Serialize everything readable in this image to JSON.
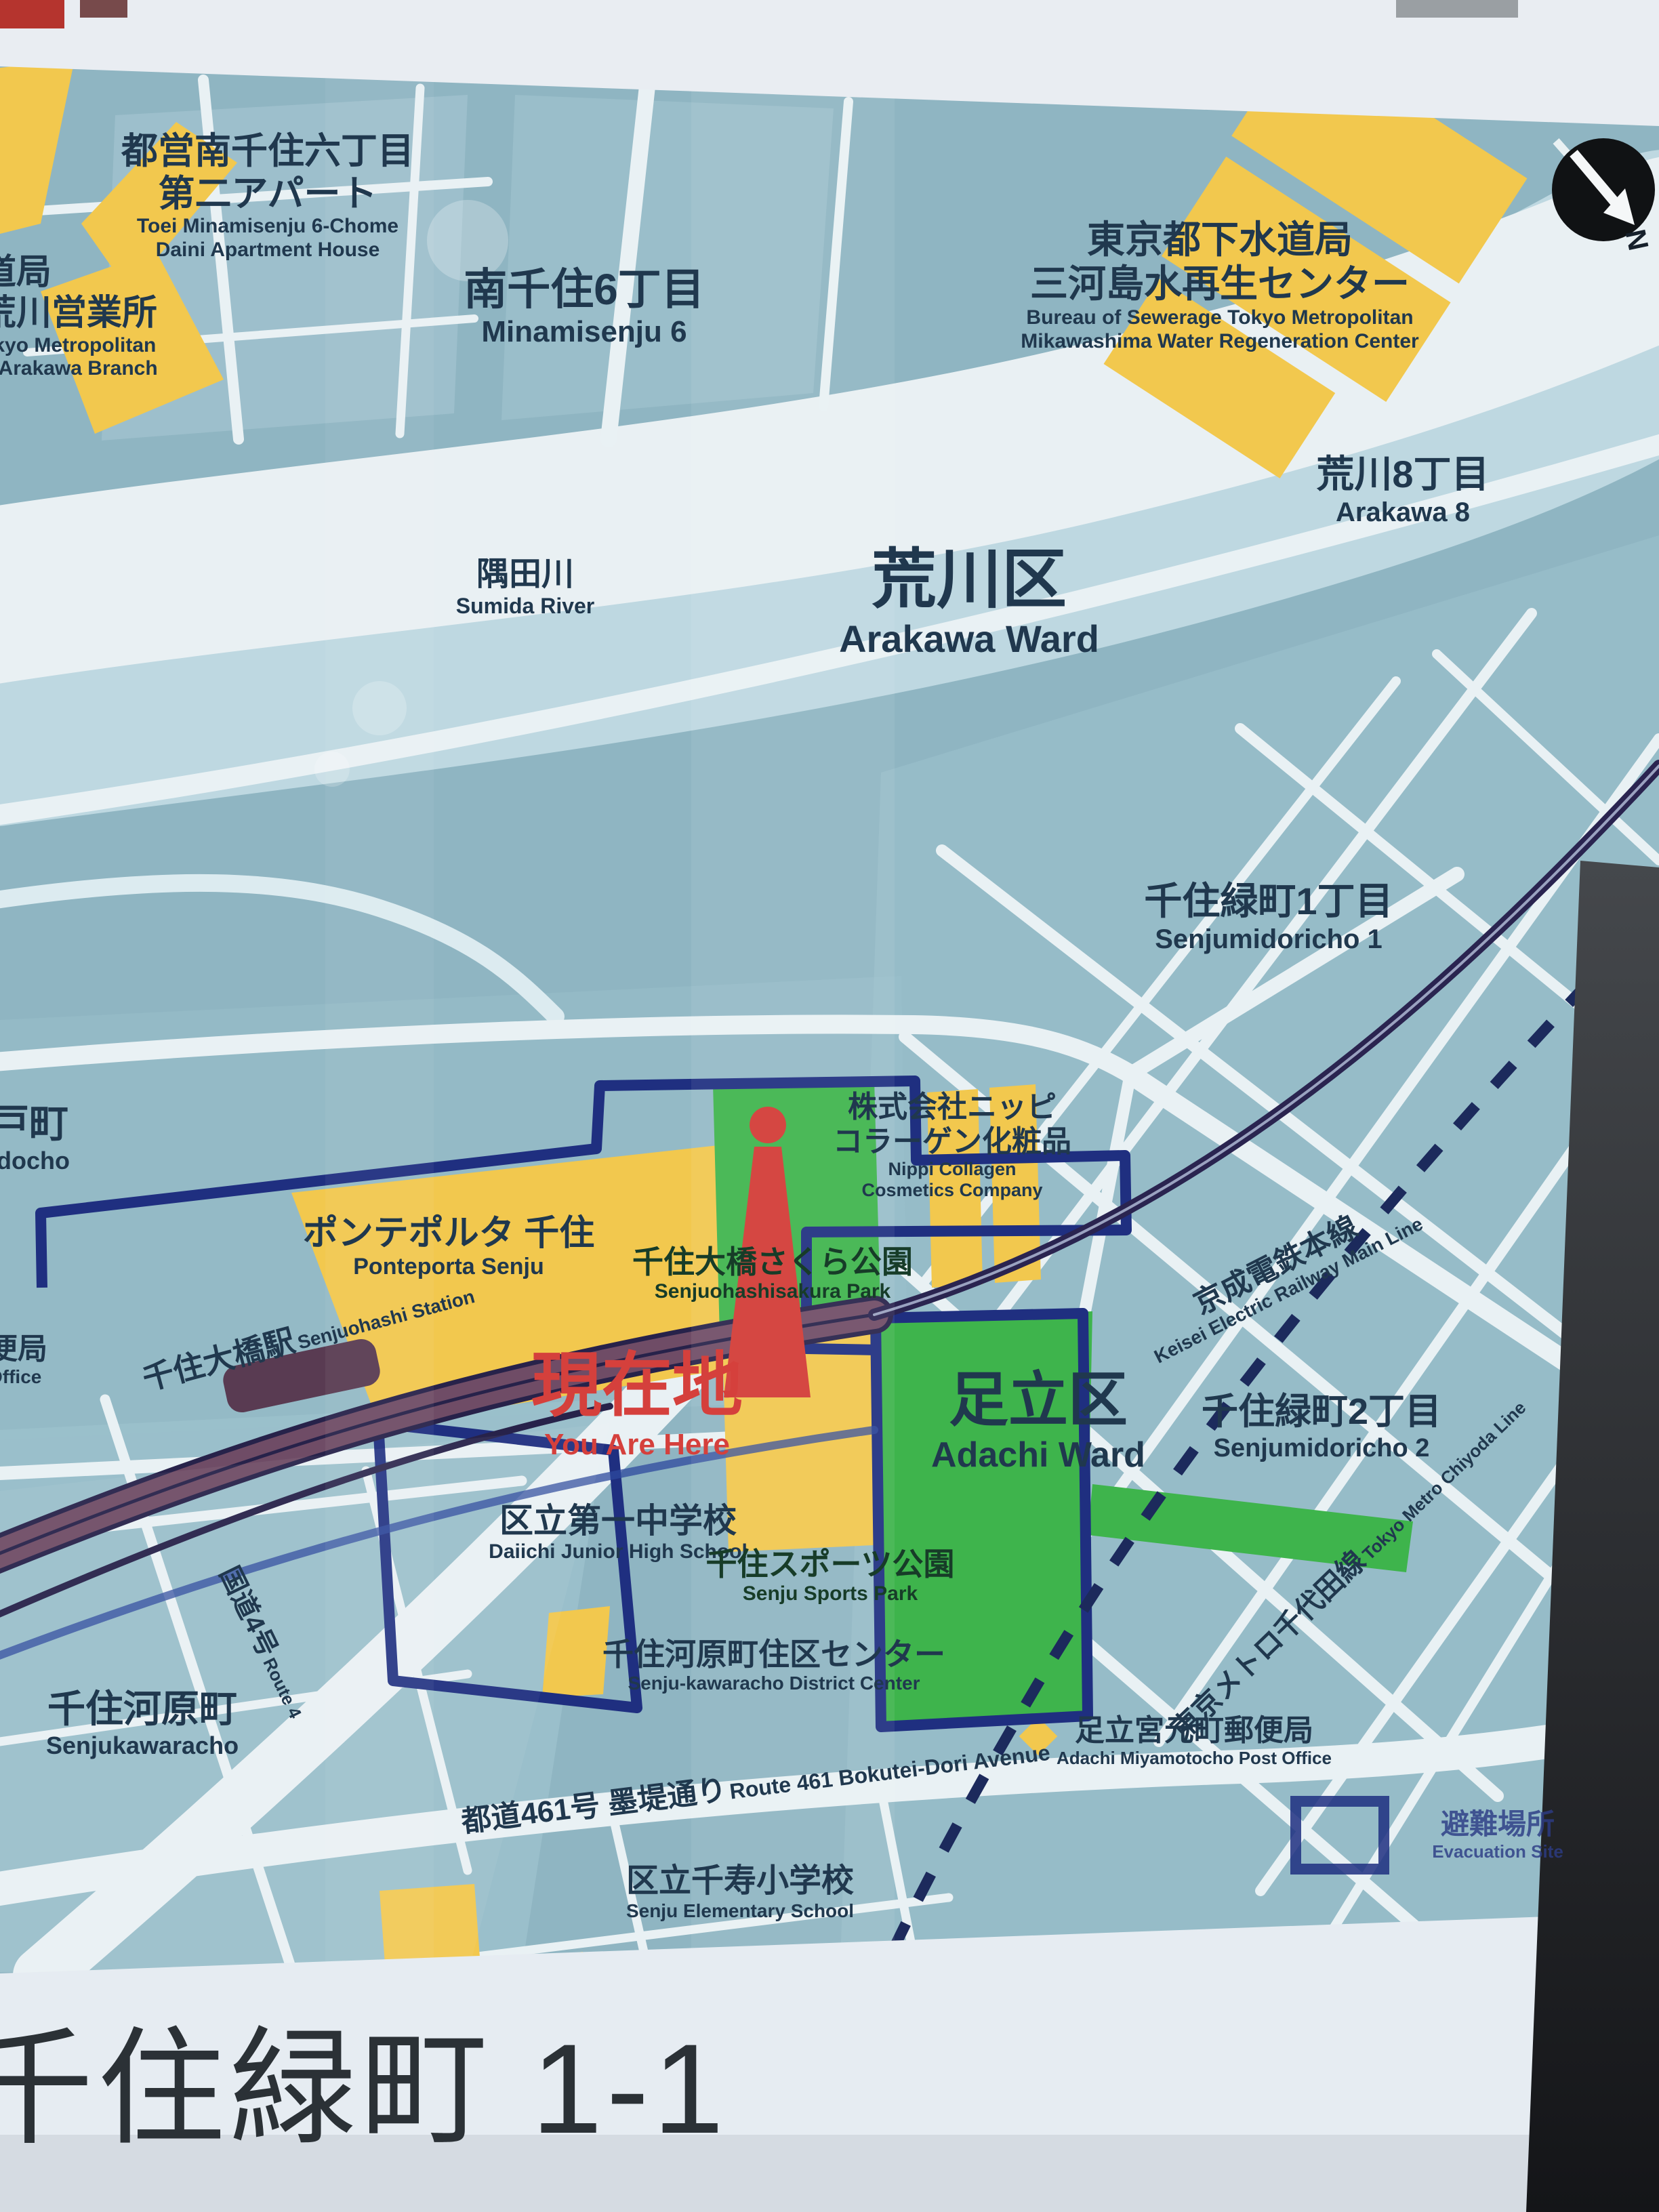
{
  "sign": {
    "title": "千住緑町 1-1",
    "compass": {
      "n": "N"
    },
    "legend": {
      "jp": "避難場所",
      "en": "Evacuation Site"
    },
    "colors": {
      "map_yellow": "#f2c84e",
      "map_green": "#3eb44c",
      "marker_red": "#d23a34",
      "boundary_navy": "#1f2f80",
      "railway_purple": "#6f4c66",
      "text_navy": "#20384e",
      "river_white": "#e9f0f3"
    },
    "labels": {
      "toei": {
        "jp1": "都営南千住六丁目",
        "jp2": "第二アパート",
        "en1": "Toei Minamisenju 6-Chome",
        "en2": "Daini Apartment House"
      },
      "waterworks": {
        "jp1": "道局",
        "jp2": "荒川営業所",
        "en1": "okyo Metropolitan",
        "en2": "d Arakawa Branch"
      },
      "minamisenju6": {
        "jp": "南千住6丁目",
        "en": "Minamisenju 6"
      },
      "sewerage": {
        "jp1": "東京都下水道局",
        "jp2": "三河島水再生センター",
        "en1": "Bureau of Sewerage Tokyo Metropolitan",
        "en2": "Mikawashima Water Regeneration Center"
      },
      "arakawa8": {
        "jp": "荒川8丁目",
        "en": "Arakawa 8"
      },
      "sumida": {
        "jp": "隅田川",
        "en": "Sumida River"
      },
      "arakawaWard": {
        "jp": "荒川区",
        "en": "Arakawa Ward"
      },
      "midoricho1": {
        "jp": "千住緑町1丁目",
        "en": "Senjumidoricho 1"
      },
      "nippi": {
        "jp1": "株式会社ニッピ",
        "jp2": "コラーゲン化粧品",
        "en1": "Nippi Collagen",
        "en2": "Cosmetics Company"
      },
      "ponteporta": {
        "jp": "ポンテポルタ 千住",
        "en": "Ponteporta Senju"
      },
      "sakuraPark": {
        "jp": "千住大橋さくら公園",
        "en": "Senjuohashisakura Park"
      },
      "keisei": {
        "jp": "京成電鉄本線",
        "en": "Keisei Electric Railway Main Line"
      },
      "station": {
        "jp": "千住大橋駅",
        "en": "Senjuohashi Station"
      },
      "youAreHere": {
        "jp": "現在地",
        "en": "You Are Here"
      },
      "adachiWard": {
        "jp": "足立区",
        "en": "Adachi Ward"
      },
      "midoricho2": {
        "jp": "千住緑町2丁目",
        "en": "Senjumidoricho 2"
      },
      "daiichi": {
        "jp": "区立第一中学校",
        "en": "Daiichi Junior High School"
      },
      "sportsPark": {
        "jp": "千住スポーツ公園",
        "en": "Senju Sports Park"
      },
      "hashidocho": {
        "jp": "戸町",
        "en": "idocho"
      },
      "postOfficeCut": {
        "jp": "便局",
        "en": "Office"
      },
      "districtCenter": {
        "jp": "千住河原町住区センター",
        "en": "Senju-kawaracho District Center"
      },
      "route4": {
        "jp": "国道4号",
        "en": "Route 4"
      },
      "kawaracho": {
        "jp": "千住河原町",
        "en": "Senjukawaracho"
      },
      "route461": {
        "jp": "都道461号 墨堤通り",
        "en": "Route 461 Bokutei-Dori Avenue"
      },
      "elementary": {
        "jp": "区立千寿小学校",
        "en": "Senju Elementary School"
      },
      "chiyoda": {
        "jp": "東京メトロ千代田線",
        "en": "Tokyo Metro Chiyoda Line"
      },
      "miyamotocho": {
        "jp": "足立宮元町郵便局",
        "en": "Adachi Miyamotocho Post Office"
      }
    }
  }
}
